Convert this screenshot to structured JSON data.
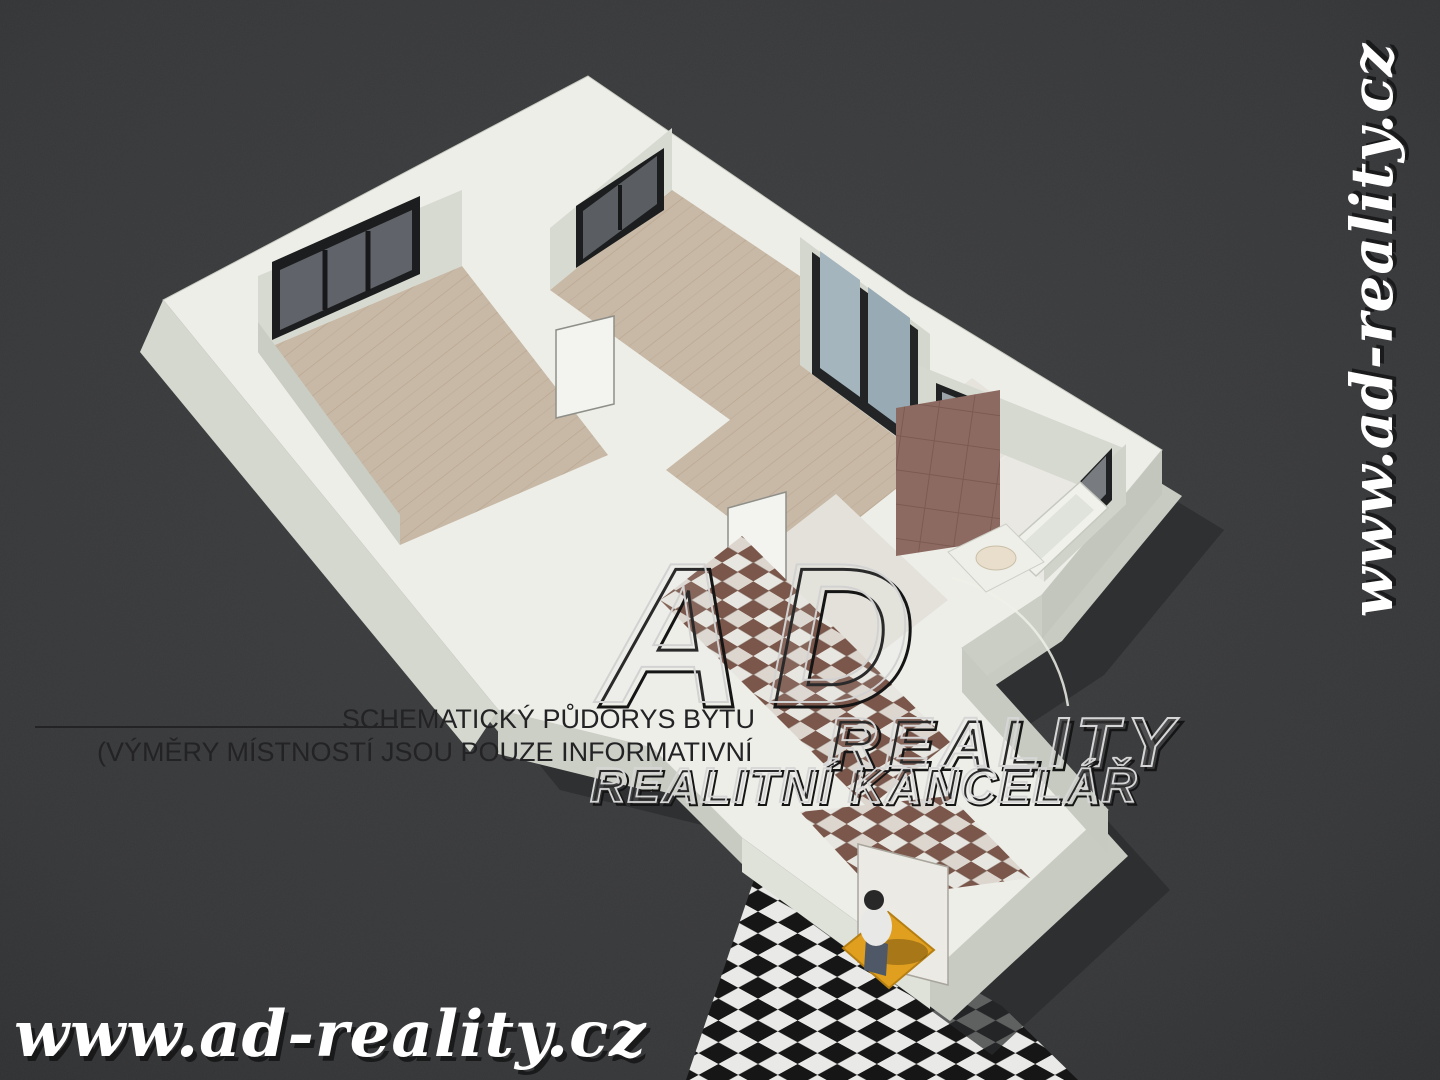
{
  "captions": {
    "line1": "SCHEMATICKÝ PŮDORYS BYTU",
    "line2": "(VÝMĚRY MÍSTNOSTÍ JSOU POUZE INFORMATIVNÍ"
  },
  "logo": {
    "monogram": "AD",
    "line1": "REALITY",
    "line2": "REALITNÍ KANCELÁŘ"
  },
  "watermark": {
    "url": "www.ad-reality.cz"
  },
  "colors": {
    "background": "#38393b",
    "wall_top": "#eeeee9",
    "wall_face": "#d7dad1",
    "wood_floor": "#c8b9a6",
    "tile_floor": "#e3e1da",
    "bath_tile_wall": "#8d6a61",
    "corridor_tile_brown": "#7b564a",
    "checker_dark": "#161616",
    "checker_light": "#e9e9e7",
    "doormat": "#e09f1f",
    "window_glass_dark": "#60646a",
    "balcony_glass": "#a4b5bd",
    "shadow": "#2a2b2d",
    "caption_text": "#232325",
    "watermark_text": "#ffffff"
  },
  "scene": {
    "shapes": [
      {
        "n": "ground-checker-floor",
        "t": "p",
        "pts": "758,868 1002,1006 1078,1080 686,1080",
        "f": "url(#p-check)"
      },
      {
        "n": "building-shadow",
        "t": "p",
        "pts": "588,76 908,295 1162,450 1042,595 962,648 1108,810 930,975 742,838 652,748 498,710 163,300",
        "dx": 62,
        "dy": 80,
        "f": "#2a2b2d",
        "o": 0.72
      },
      {
        "n": "building-wall-body",
        "t": "p",
        "pts": "588,76 908,295 1162,450 1042,595 962,648 1108,810 930,975 742,838 652,748 498,710 163,300",
        "dx": 20,
        "dy": 46,
        "f": "#c7cbc1"
      },
      {
        "n": "building-wall-tops",
        "t": "p",
        "pts": "588,76 908,295 1162,450 1042,595 962,648 1108,810 930,975 742,838 652,748 498,710 163,300",
        "f": "#eeeee9",
        "s": "#c9ccc3",
        "w": 1
      },
      {
        "n": "outer-wall-face-west",
        "t": "p",
        "pts": "163,300 498,710 470,752 140,352",
        "f": "#d5d8cf"
      },
      {
        "n": "outer-wall-face-south",
        "t": "p",
        "pts": "498,710 652,748 652,792 498,754",
        "f": "#cccfc6"
      },
      {
        "n": "outer-wall-face-wing-south",
        "t": "p",
        "pts": "1042,595 962,648 962,692 1042,639",
        "f": "#cacec5"
      },
      {
        "n": "outer-wall-face-wing-east",
        "t": "p",
        "pts": "1162,450 1042,595 1042,639 1162,494",
        "f": "#c2c6bd"
      },
      {
        "n": "outer-wall-face-corridor-east",
        "t": "p",
        "pts": "962,648 1108,810 1108,854 962,692",
        "f": "#c6cac1"
      },
      {
        "n": "room1-floor",
        "t": "p",
        "pts": "258,352 462,266 608,455 400,545",
        "f": "url(#p-wood)"
      },
      {
        "n": "room1-wall-face-nw",
        "t": "p",
        "pts": "258,352 462,266 462,190 258,276",
        "f": "#d7dad1"
      },
      {
        "n": "room1-wall-face-w",
        "t": "p",
        "pts": "258,352 400,545 400,515 258,322",
        "f": "#c9cdc4"
      },
      {
        "n": "window-room1-frame",
        "t": "p",
        "pts": "272,340 272,262 420,196 420,274",
        "f": "#1c1d1e"
      },
      {
        "n": "window-room1-glass",
        "t": "p",
        "pts": "280,330 280,270 412,210 412,270",
        "f": "#60646a"
      },
      {
        "n": "window-room1-mullion-1",
        "t": "l",
        "x1": 325,
        "y1": 250,
        "x2": 325,
        "y2": 310,
        "s": "#17181a",
        "w": 5
      },
      {
        "n": "window-room1-mullion-2",
        "t": "l",
        "x1": 368,
        "y1": 231,
        "x2": 368,
        "y2": 291,
        "s": "#17181a",
        "w": 5
      },
      {
        "n": "room2-floor",
        "t": "p",
        "pts": "550,290 672,190 880,330 758,440",
        "f": "url(#p-wood)"
      },
      {
        "n": "room2-wall-face-nw",
        "t": "p",
        "pts": "550,290 672,190 672,128 550,228",
        "f": "#d7dad1"
      },
      {
        "n": "window-room2-frame",
        "t": "p",
        "pts": "576,268 576,206 664,148 664,210",
        "f": "#1c1d1e"
      },
      {
        "n": "window-room2-glass",
        "t": "p",
        "pts": "583,259 583,211 657,156 657,204",
        "f": "#5a5e63"
      },
      {
        "n": "window-room2-mullion",
        "t": "l",
        "x1": 620,
        "y1": 185,
        "x2": 620,
        "y2": 230,
        "s": "#17181a",
        "w": 4
      },
      {
        "n": "living-floor",
        "t": "p",
        "pts": "666,470 800,365 930,462 796,568",
        "f": "url(#p-wood)"
      },
      {
        "n": "living-wall-face-ne",
        "t": "p",
        "pts": "800,365 930,462 930,334 800,237",
        "f": "#d4d7ce"
      },
      {
        "n": "balcony-door-frame",
        "t": "p",
        "pts": "812,374 918,452 918,330 812,252",
        "f": "#232425"
      },
      {
        "n": "balcony-door-glass-left",
        "t": "p",
        "pts": "820,368 860,397 860,280 820,251",
        "f": "#a4b5bd"
      },
      {
        "n": "balcony-door-glass-right",
        "t": "p",
        "pts": "868,403 910,434 910,318 868,287",
        "f": "#98aab3"
      },
      {
        "n": "hall-floor",
        "t": "p",
        "pts": "746,564 836,494 948,600 858,670",
        "f": "#e3e1da"
      },
      {
        "n": "door-room1",
        "t": "p",
        "pts": "556,418 556,330 614,316 614,404",
        "f": "#f3f3ef",
        "s": "#8f8f89",
        "w": 1.5
      },
      {
        "n": "door-hall",
        "t": "p",
        "pts": "728,598 728,508 786,492 786,582",
        "f": "#f3f3ef",
        "s": "#8f8f89",
        "w": 1.5
      },
      {
        "n": "corridor-floor-tiles",
        "t": "p",
        "pts": "660,600 742,536 950,742 868,808",
        "f": "url(#p-cubes)"
      },
      {
        "n": "door-swing-arc",
        "t": "path",
        "d": "M 952 578 A 155 155 0 0 1 1068 706",
        "s": "#eef0e8",
        "w": 2.5,
        "o": 0.85
      },
      {
        "n": "kitchen-floor",
        "t": "p",
        "pts": "918,420 972,378 1040,428 984,472",
        "f": "#e5e3dc"
      },
      {
        "n": "bath-floor",
        "t": "p",
        "pts": "952,498 1034,434 1126,504 1044,582",
        "f": "#e9e8e2"
      },
      {
        "n": "wing-wall-face-n",
        "t": "p",
        "pts": "918,420 1126,504 1126,449 918,365",
        "f": "#d6d9d0"
      },
      {
        "n": "window-kitchen-frame",
        "t": "p",
        "pts": "936,427 998,452 998,408 936,383",
        "f": "#202122"
      },
      {
        "n": "window-kitchen-glass",
        "t": "p",
        "pts": "942,425 992,445 992,412 942,392",
        "f": "#9aa4a8"
      },
      {
        "n": "wing-wall-face-e",
        "t": "p",
        "pts": "1126,504 1044,582 1044,522 1126,444",
        "f": "#cfd3ca"
      },
      {
        "n": "window-bath-frame",
        "t": "p",
        "pts": "1112,448 1112,500 1064,550 1064,498",
        "f": "#202122"
      },
      {
        "n": "window-bath-glass",
        "t": "p",
        "pts": "1106,456 1106,494 1070,532 1070,494",
        "f": "#787c80"
      },
      {
        "n": "bath-tile-wall",
        "t": "p",
        "pts": "896,556 896,408 1000,390 1000,540",
        "f": "url(#p-tilewall)"
      },
      {
        "n": "bathtub",
        "t": "p",
        "pts": "1080,482 1108,508 1036,576 1006,548",
        "f": "#f0f1eb",
        "s": "#c6c9c0",
        "w": 1.5
      },
      {
        "n": "bathtub-inner",
        "t": "p",
        "pts": "1076,494 1094,510 1040,560 1022,544",
        "f": "#e0e2dc"
      },
      {
        "n": "washbasin-cabinet",
        "t": "p",
        "pts": "948,552 1006,524 1044,562 986,592",
        "f": "#efefe9",
        "s": "#cdd0c7",
        "w": 1
      },
      {
        "n": "washbasin",
        "t": "e",
        "cx": 996,
        "cy": 558,
        "rx": 20,
        "ry": 12,
        "f": "#e8decb",
        "s": "#c9bfa8",
        "w": 1
      },
      {
        "n": "vestibule-floor-tiles",
        "t": "p",
        "pts": "800,812 950,796 1030,878 880,898",
        "f": "url(#p-cubes)"
      },
      {
        "n": "vestibule-front-face",
        "t": "p",
        "pts": "742,838 930,975 930,1009 742,872",
        "f": "#dfe2d9"
      },
      {
        "n": "entrance-door",
        "t": "p",
        "pts": "858,844 948,867 948,985 858,962",
        "f": "#eceae4",
        "s": "#a8a59d",
        "w": 1.5
      },
      {
        "n": "entrance-door-handle",
        "t": "e",
        "cx": 870,
        "cy": 916,
        "rx": 3,
        "ry": 3,
        "f": "#55534e"
      },
      {
        "n": "doormat",
        "t": "p",
        "pts": "843,948 888,912 934,950 889,988",
        "f": "#e09f1f",
        "s": "#b57f13",
        "w": 2
      },
      {
        "n": "person-shadow",
        "t": "e",
        "cx": 898,
        "cy": 952,
        "rx": 30,
        "ry": 13,
        "f": "#000000",
        "o": 0.25
      },
      {
        "n": "person-legs",
        "t": "p",
        "pts": "866,938 888,944 886,976 864,970",
        "f": "#4e5866"
      },
      {
        "n": "person-body",
        "t": "e",
        "cx": 876,
        "cy": 926,
        "rx": 16,
        "ry": 20,
        "f": "#e8e8e6"
      },
      {
        "n": "person-head",
        "t": "e",
        "cx": 874,
        "cy": 900,
        "rx": 10,
        "ry": 10,
        "f": "#282828"
      },
      {
        "n": "caption-underline",
        "t": "l",
        "x1": 35,
        "y1": 727,
        "x2": 398,
        "y2": 727,
        "s": "#232325",
        "w": 2
      }
    ]
  },
  "texts": [
    {
      "n": "caption-line1",
      "ref": "captions.line1",
      "x": 755,
      "y": 728,
      "anchor": "end",
      "size": 27,
      "f": "#232325"
    },
    {
      "n": "caption-line2",
      "ref": "captions.line2",
      "x": 97,
      "y": 761,
      "size": 27,
      "f": "#232325"
    },
    {
      "n": "logo-monogram",
      "ref": "logo.monogram",
      "x": 598,
      "y": 702,
      "size": 200,
      "b": 1,
      "i": 1,
      "ls": 24,
      "f": "rgba(235,235,235,0.10)",
      "s": "#d2d2d2",
      "w": 2,
      "sh": {
        "dx": 5,
        "dy": 5,
        "s": "#151515",
        "w": 3
      }
    },
    {
      "n": "logo-reality",
      "ref": "logo.line1",
      "x": 826,
      "y": 766,
      "size": 70,
      "b": 1,
      "i": 1,
      "ls": 8,
      "f": "rgba(235,235,235,0.10)",
      "s": "#d6d6d6",
      "w": 2,
      "sh": {
        "dx": 4,
        "dy": 4,
        "s": "#151515",
        "w": 2.5
      }
    },
    {
      "n": "logo-kancelar",
      "ref": "logo.line2",
      "x": 590,
      "y": 802,
      "size": 49,
      "b": 1,
      "i": 1,
      "ls": 2,
      "f": "rgba(235,235,235,0.10)",
      "s": "#d6d6d6",
      "w": 1.8,
      "sh": {
        "dx": 3,
        "dy": 3,
        "s": "#151515",
        "w": 2
      }
    },
    {
      "n": "watermark-bottom",
      "ref": "watermark.url",
      "x": 14,
      "y": 1056,
      "size": 64,
      "b": 1,
      "i": 1,
      "fam": "serif",
      "ls": 1,
      "f": "#ffffff",
      "sh": {
        "dx": 4,
        "dy": 5,
        "f": "rgba(0,0,0,0.55)"
      }
    },
    {
      "n": "watermark-right",
      "ref": "watermark.url",
      "x": 1392,
      "y": 330,
      "anchor": "middle",
      "size": 58,
      "b": 1,
      "i": 1,
      "fam": "serif",
      "ls": 1,
      "f": "#ffffff",
      "tr": "rotate(-90 1392 330)",
      "sh": {
        "dx": 3,
        "dy": 4,
        "f": "rgba(0,0,0,0.55)"
      }
    }
  ]
}
